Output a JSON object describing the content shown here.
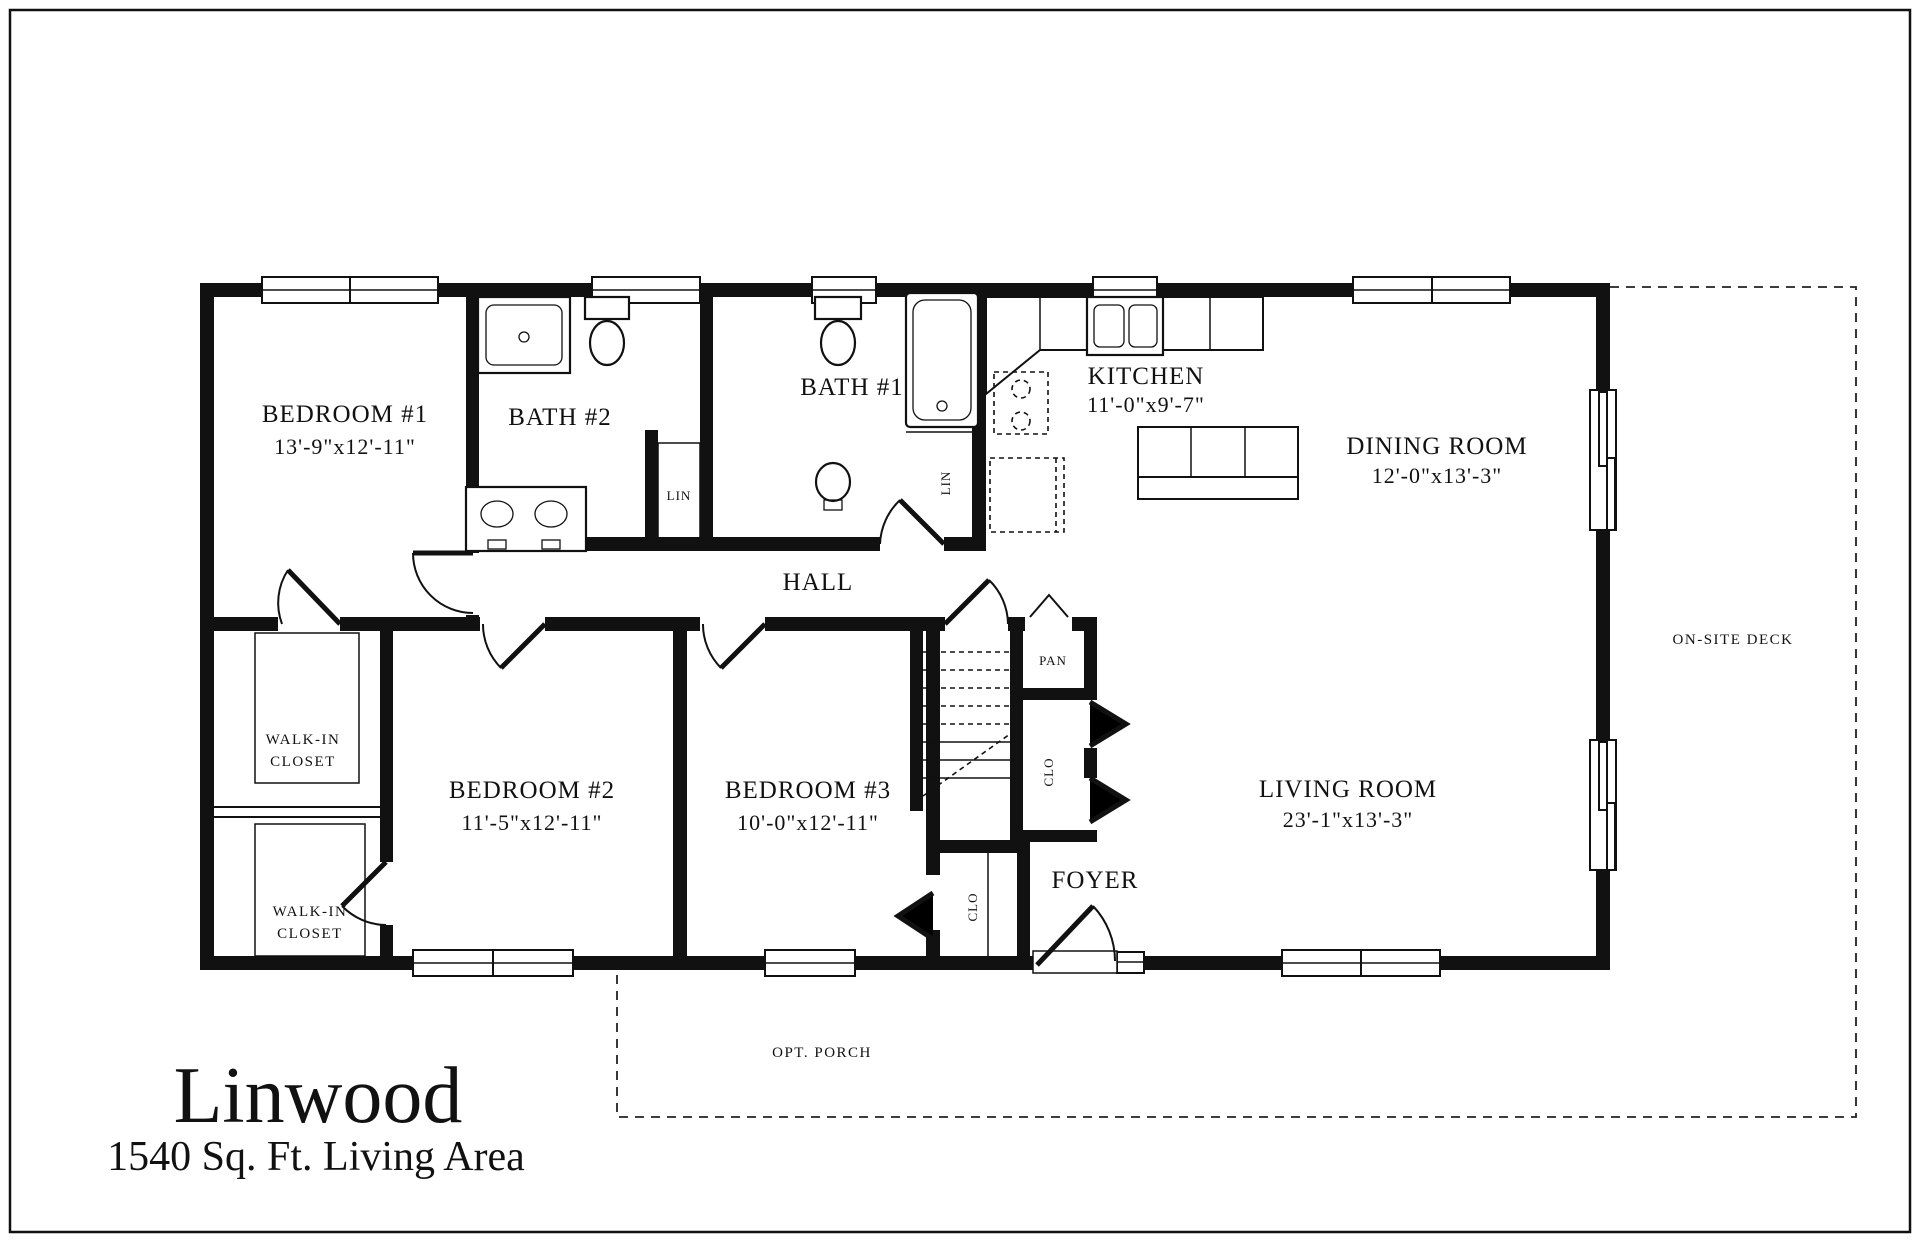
{
  "title": {
    "name": "Linwood",
    "subtitle": "1540 Sq. Ft. Living Area"
  },
  "rooms": {
    "bedroom1": {
      "label": "BEDROOM #1",
      "dims": "13'-9\"x12'-11\""
    },
    "bedroom2": {
      "label": "BEDROOM #2",
      "dims": "11'-5\"x12'-11\""
    },
    "bedroom3": {
      "label": "BEDROOM #3",
      "dims": "10'-0\"x12'-11\""
    },
    "bath1": {
      "label": "BATH #1"
    },
    "bath2": {
      "label": "BATH #2"
    },
    "kitchen": {
      "label": "KITCHEN",
      "dims": "11'-0\"x9'-7\""
    },
    "dining": {
      "label": "DINING ROOM",
      "dims": "12'-0\"x13'-3\""
    },
    "living": {
      "label": "LIVING ROOM",
      "dims": "23'-1\"x13'-3\""
    },
    "hall": {
      "label": "HALL"
    },
    "foyer": {
      "label": "FOYER"
    },
    "walkin_closet_upper": {
      "line1": "WALK-IN",
      "line2": "CLOSET"
    },
    "walkin_closet_lower": {
      "line1": "WALK-IN",
      "line2": "CLOSET"
    },
    "pantry": {
      "label": "PAN"
    },
    "coat_closet": {
      "label": "CLO"
    },
    "bedroom3_closet": {
      "label": "CLO"
    },
    "linen_baths": {
      "label": "LIN"
    },
    "linen_bath1": {
      "label": "LIN"
    },
    "deck": {
      "label": "ON-SITE DECK"
    },
    "porch": {
      "label": "OPT. PORCH"
    }
  }
}
